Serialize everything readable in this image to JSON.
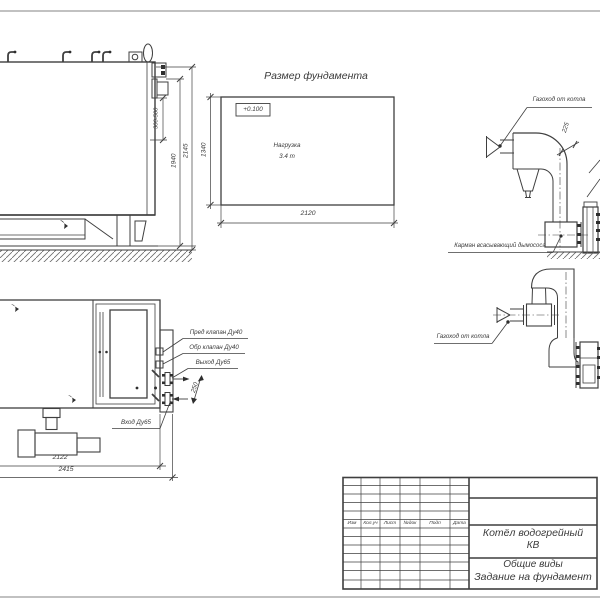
{
  "colors": {
    "line": "#3f3f3f",
    "text": "#3a3a3a",
    "page_edge": "#b8b8b8",
    "background": "#ffffff"
  },
  "foundation_plan": {
    "title": "Размер фундамента",
    "level_mark": "+0.100",
    "load_line1": "Нагрузка",
    "load_line2": "3.4 т",
    "dim_width": "2120",
    "dim_depth": "1340"
  },
  "boiler_side_view": {
    "dim_range": "300-500",
    "dim_boiler_height": "1940",
    "dim_total_height": "2145"
  },
  "boiler_plan_view": {
    "label_safety_valve": "Пред клапан Ду40",
    "label_check_valve": "Обр клапан Ду40",
    "label_outlet": "Выход Ду65",
    "label_inlet": "Вход Ду65",
    "dim_nozzle_offset": "250",
    "dim_length_body": "2122",
    "dim_length_total": "2415"
  },
  "flue_elevation_view": {
    "label_duct": "Газоход от котла",
    "label_pocket": "Карман всасывающий дымососа",
    "dim_duct": "225"
  },
  "flue_plan_view": {
    "label_duct": "Газоход от котла"
  },
  "title_block": {
    "columns": [
      "Изм",
      "Кол.уч",
      "Лист",
      "№док",
      "Подп",
      "Дата"
    ],
    "product_line1": "Котёл водогрейный",
    "product_line2": "КВ",
    "doc_line1": "Общие виды",
    "doc_line2": "Задание на фундамент"
  }
}
